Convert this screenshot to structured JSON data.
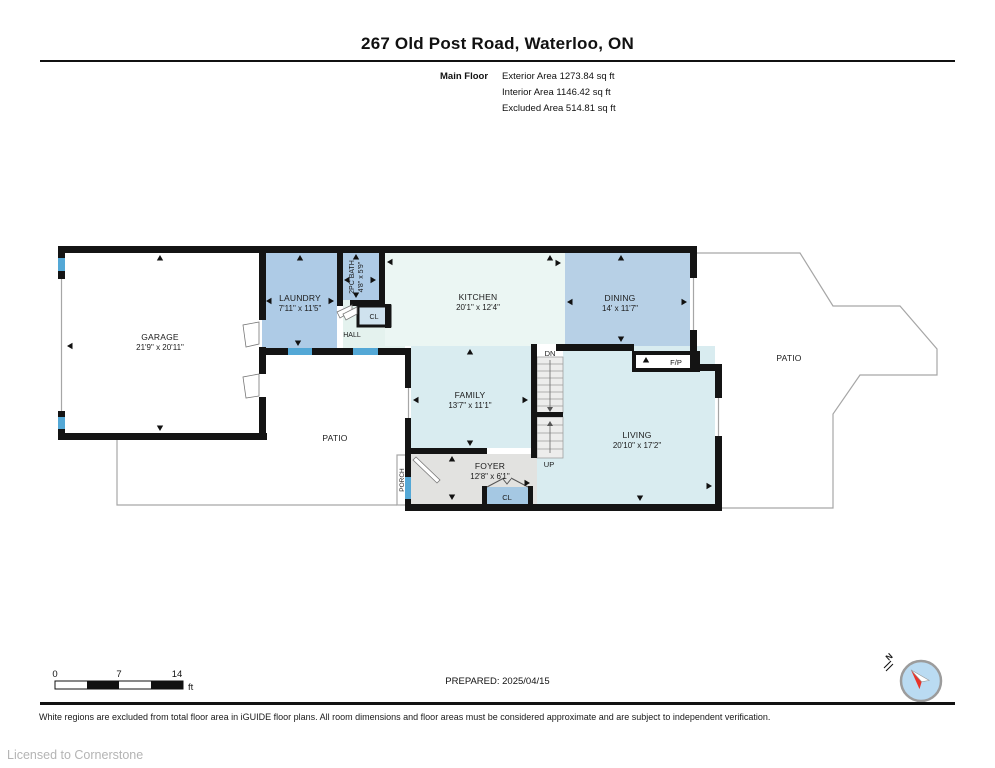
{
  "header": {
    "title": "267 Old Post Road, Waterloo, ON",
    "floor_label": "Main Floor",
    "areas": {
      "exterior": "Exterior Area 1273.84 sq ft",
      "interior": "Interior Area 1146.42 sq ft",
      "excluded": "Excluded Area 514.81 sq ft"
    }
  },
  "rooms": {
    "garage": {
      "name": "GARAGE",
      "dims": "21'9\" x 20'11\""
    },
    "laundry": {
      "name": "LAUNDRY",
      "dims": "7'11\" x 11'5\""
    },
    "bath": {
      "name": "2PC BATH",
      "dims": "4'8\" x 5'9\""
    },
    "kitchen": {
      "name": "KITCHEN",
      "dims": "20'1\" x 12'4\""
    },
    "dining": {
      "name": "DINING",
      "dims": "14' x 11'7\""
    },
    "family": {
      "name": "FAMILY",
      "dims": "13'7\" x 11'1\""
    },
    "living": {
      "name": "LIVING",
      "dims": "20'10\" x 17'2\""
    },
    "foyer": {
      "name": "FOYER",
      "dims": "12'8\" x 6'1\""
    }
  },
  "labels": {
    "hall": "HALL",
    "hall_closet": "CL",
    "foyer_closet": "CL",
    "patio_left": "PATIO",
    "patio_right": "PATIO",
    "porch": "PORCH",
    "fireplace": "F/P",
    "stairs_down": "DN",
    "stairs_up": "UP"
  },
  "footer": {
    "scale": {
      "zero": "0",
      "mid": "7",
      "max": "14",
      "unit": "ft"
    },
    "prepared": "PREPARED: 2025/04/15",
    "compass_label": "N",
    "disclaimer": "White regions are excluded from total floor area in iGUIDE floor plans. All room dimensions and floor areas must be considered approximate and are subject to independent verification.",
    "license": "Licensed to Cornerstone"
  },
  "colors": {
    "wall": "#141414",
    "room_blue": "#aecbe6",
    "dining_blue": "#b7d0e6",
    "room_cyan": "#d9ecf0",
    "kitchen_tint": "#ebf6f3",
    "hall_tint": "#e4f2ee",
    "foyer_gray": "#e2e2e0",
    "closet_blue": "#a5c8e3",
    "window_blue": "#54a8d6",
    "outline_gray": "#a6a6a6",
    "compass_fill": "#badbf2",
    "needle_red": "#e8342a"
  }
}
